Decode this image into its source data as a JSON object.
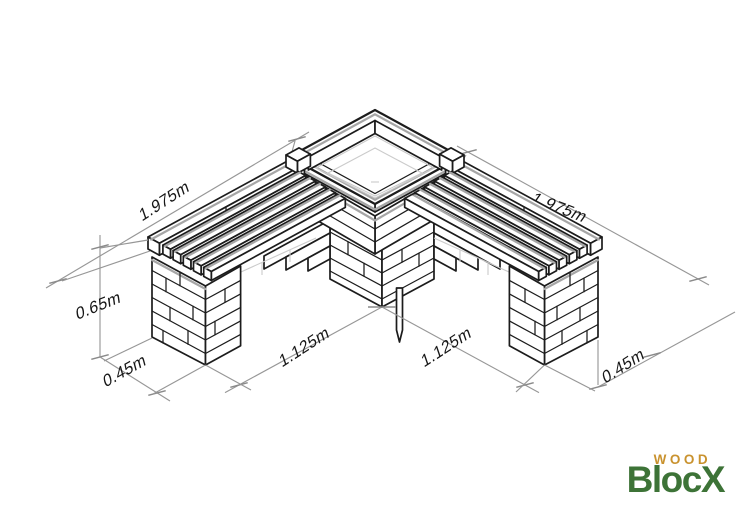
{
  "title": "WoodBlocX corner bench with planter - isometric dimension drawing",
  "dimensions": {
    "back_left": "1.975m",
    "back_right": "1.975m",
    "height": "0.65m",
    "depth_left": "0.45m",
    "depth_right": "0.45m",
    "span_left": "1.125m",
    "span_right": "1.125m"
  },
  "logo": {
    "word_top": "WOOD",
    "word_bottom": "BlocX",
    "color_green": "#3d7337",
    "color_orange": "#c9922e"
  },
  "drawing_colors": {
    "line": "#1c1c1c",
    "accent_gray": "#a6a6a6",
    "dimension_gray": "#979797",
    "hidden_gray": "#cbcbcb",
    "background": "#ffffff"
  }
}
